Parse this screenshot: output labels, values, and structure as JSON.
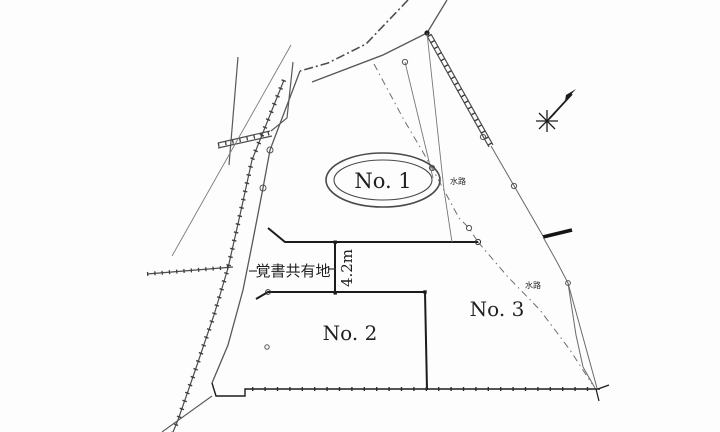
{
  "map": {
    "type": "cadastral-survey-plan",
    "parcels": {
      "no1": {
        "label": "No. 1"
      },
      "no2": {
        "label": "No. 2"
      },
      "no3": {
        "label": "No. 3"
      }
    },
    "annotations": {
      "shared_land_label": "覚書共有地",
      "strip_width_label": "4.2m",
      "waterway_label_upper": "水路",
      "waterway_label_lower": "水路"
    },
    "icons": {
      "north_symbol": "north-arrow-star"
    },
    "colors": {
      "background": "#fdfdfd",
      "thin_line": "#5b5b5b",
      "bold_line": "#1c1c1c",
      "dashed_line": "#6e6e6e",
      "ellipse_stroke": "#4a4a4a"
    }
  }
}
